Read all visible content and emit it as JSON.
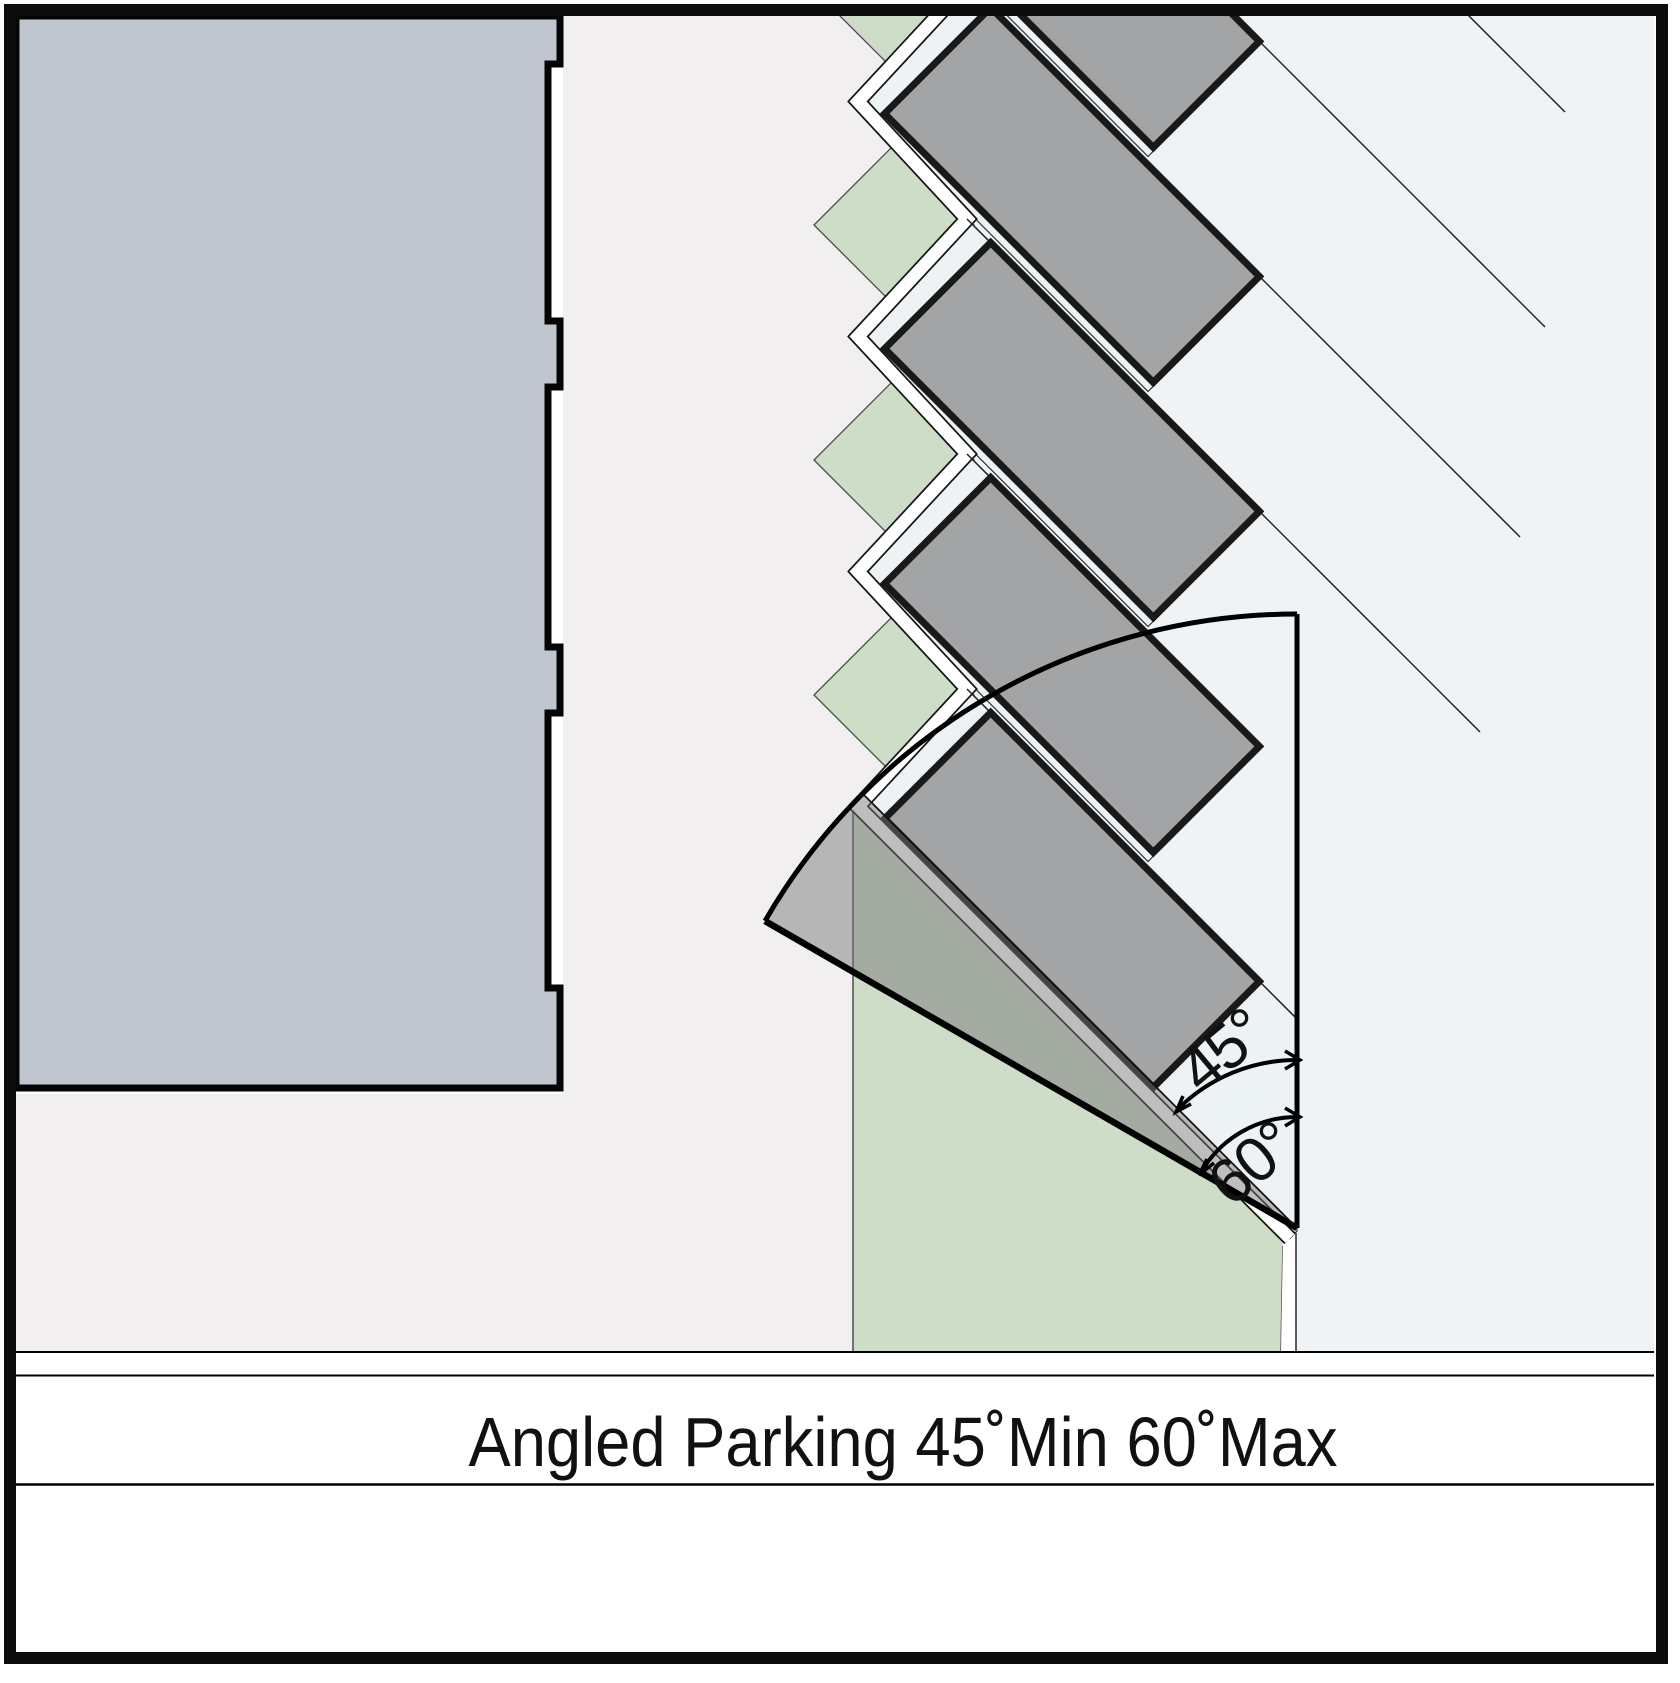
{
  "figure": {
    "caption": "Angled Parking 45˚Min 60˚Max",
    "angle_min_label": "45°",
    "angle_max_label": "60°",
    "angle_min_value": 45,
    "angle_max_value": 60
  },
  "colors": {
    "frame_line": "#0c0c0c",
    "background_left": "#f1eff0",
    "background_right": "#eff3f5",
    "stall_area": "#edf2f4",
    "building_fill": "#c0c6ce",
    "car_fill": "#a3a4a6",
    "landscape_green": "#cdddc7",
    "fan_overlay": "#787878",
    "thin_line": "#222222",
    "white_channel": "#ffffff"
  },
  "legend": {
    "building": "building footprint",
    "stalls": "angled parking stalls",
    "cars": "parked cars",
    "landscape": "landscape islands and strip",
    "fan": "parking angle sweep 45 to 60 degrees"
  }
}
